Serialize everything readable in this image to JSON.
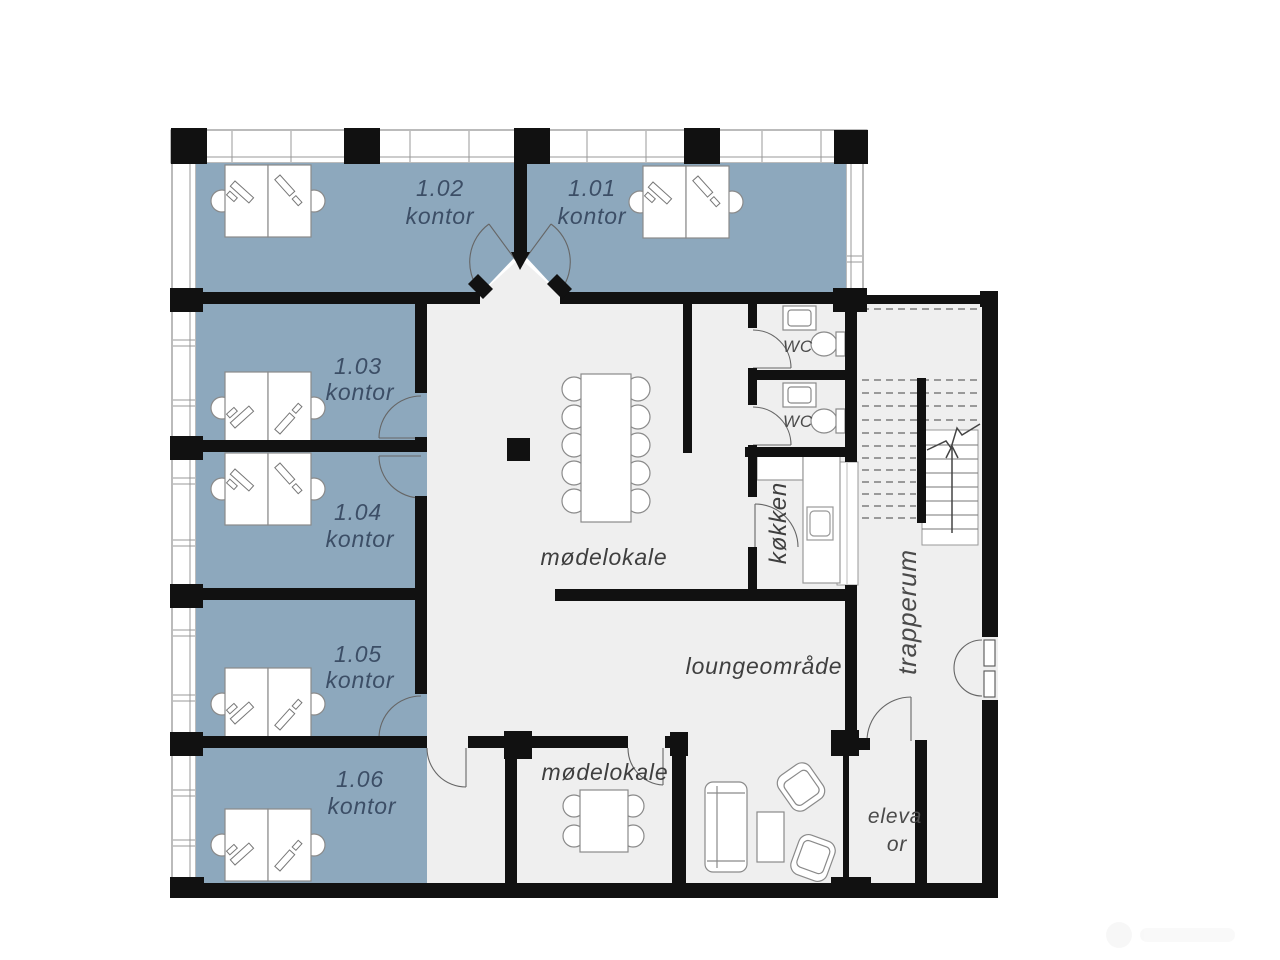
{
  "colors": {
    "office_fill": "#8da8bd",
    "common_fill": "#efefef",
    "wall": "#111111",
    "office_label": "#3c4e66",
    "common_label": "#3f3f3f"
  },
  "rooms": {
    "offices": [
      {
        "number": "1.02",
        "type": "kontor"
      },
      {
        "number": "1.01",
        "type": "kontor"
      },
      {
        "number": "1.03",
        "type": "kontor"
      },
      {
        "number": "1.04",
        "type": "kontor"
      },
      {
        "number": "1.05",
        "type": "kontor"
      },
      {
        "number": "1.06",
        "type": "kontor"
      }
    ],
    "meeting_main": {
      "name": "mødelokale"
    },
    "meeting_small": {
      "name": "mødelokale"
    },
    "lounge": {
      "name": "loungeområde"
    },
    "kitchen": {
      "name": "køkken"
    },
    "stairwell": {
      "name": "trapperum"
    },
    "wc1": {
      "name": "WC"
    },
    "wc2": {
      "name": "WC"
    },
    "elevator": {
      "line1": "eleva",
      "line2": "or"
    }
  }
}
